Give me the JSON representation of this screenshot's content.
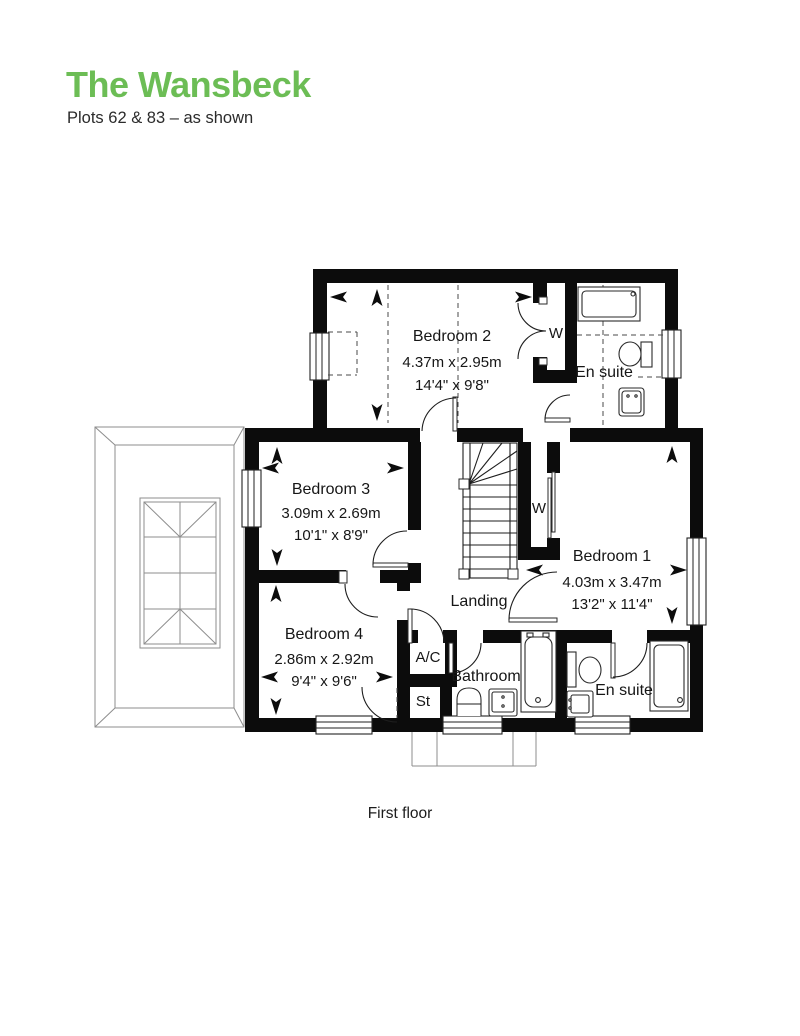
{
  "header": {
    "title": "The Wansbeck",
    "subtitle": "Plots 62 & 83 – as shown",
    "title_color": "#6cbd55"
  },
  "caption": "First floor",
  "colors": {
    "title_green": "#6cbd55",
    "wall_black": "#0c0c0c",
    "roof_gray": "#8d8d8d"
  },
  "rooms": {
    "bedroom1": {
      "name": "Bedroom 1",
      "metric": "4.03m x 3.47m",
      "imperial": "13'2\" x 11'4\""
    },
    "bedroom2": {
      "name": "Bedroom 2",
      "metric": "4.37m x 2.95m",
      "imperial": "14'4\" x 9'8\""
    },
    "bedroom3": {
      "name": "Bedroom 3",
      "metric": "3.09m x 2.69m",
      "imperial": "10'1\" x 8'9\""
    },
    "bedroom4": {
      "name": "Bedroom 4",
      "metric": "2.86m x 2.92m",
      "imperial": "9'4\" x 9'6\""
    },
    "landing": {
      "name": "Landing"
    },
    "bathroom": {
      "name": "Bathroom"
    },
    "ensuite_top": {
      "name": "En suite"
    },
    "ensuite_bottom": {
      "name": "En suite"
    },
    "wardrobe_top": {
      "name": "W"
    },
    "wardrobe_bedroom1": {
      "name": "W"
    },
    "airing_cupboard": {
      "name": "A/C"
    },
    "store": {
      "name": "St"
    }
  }
}
